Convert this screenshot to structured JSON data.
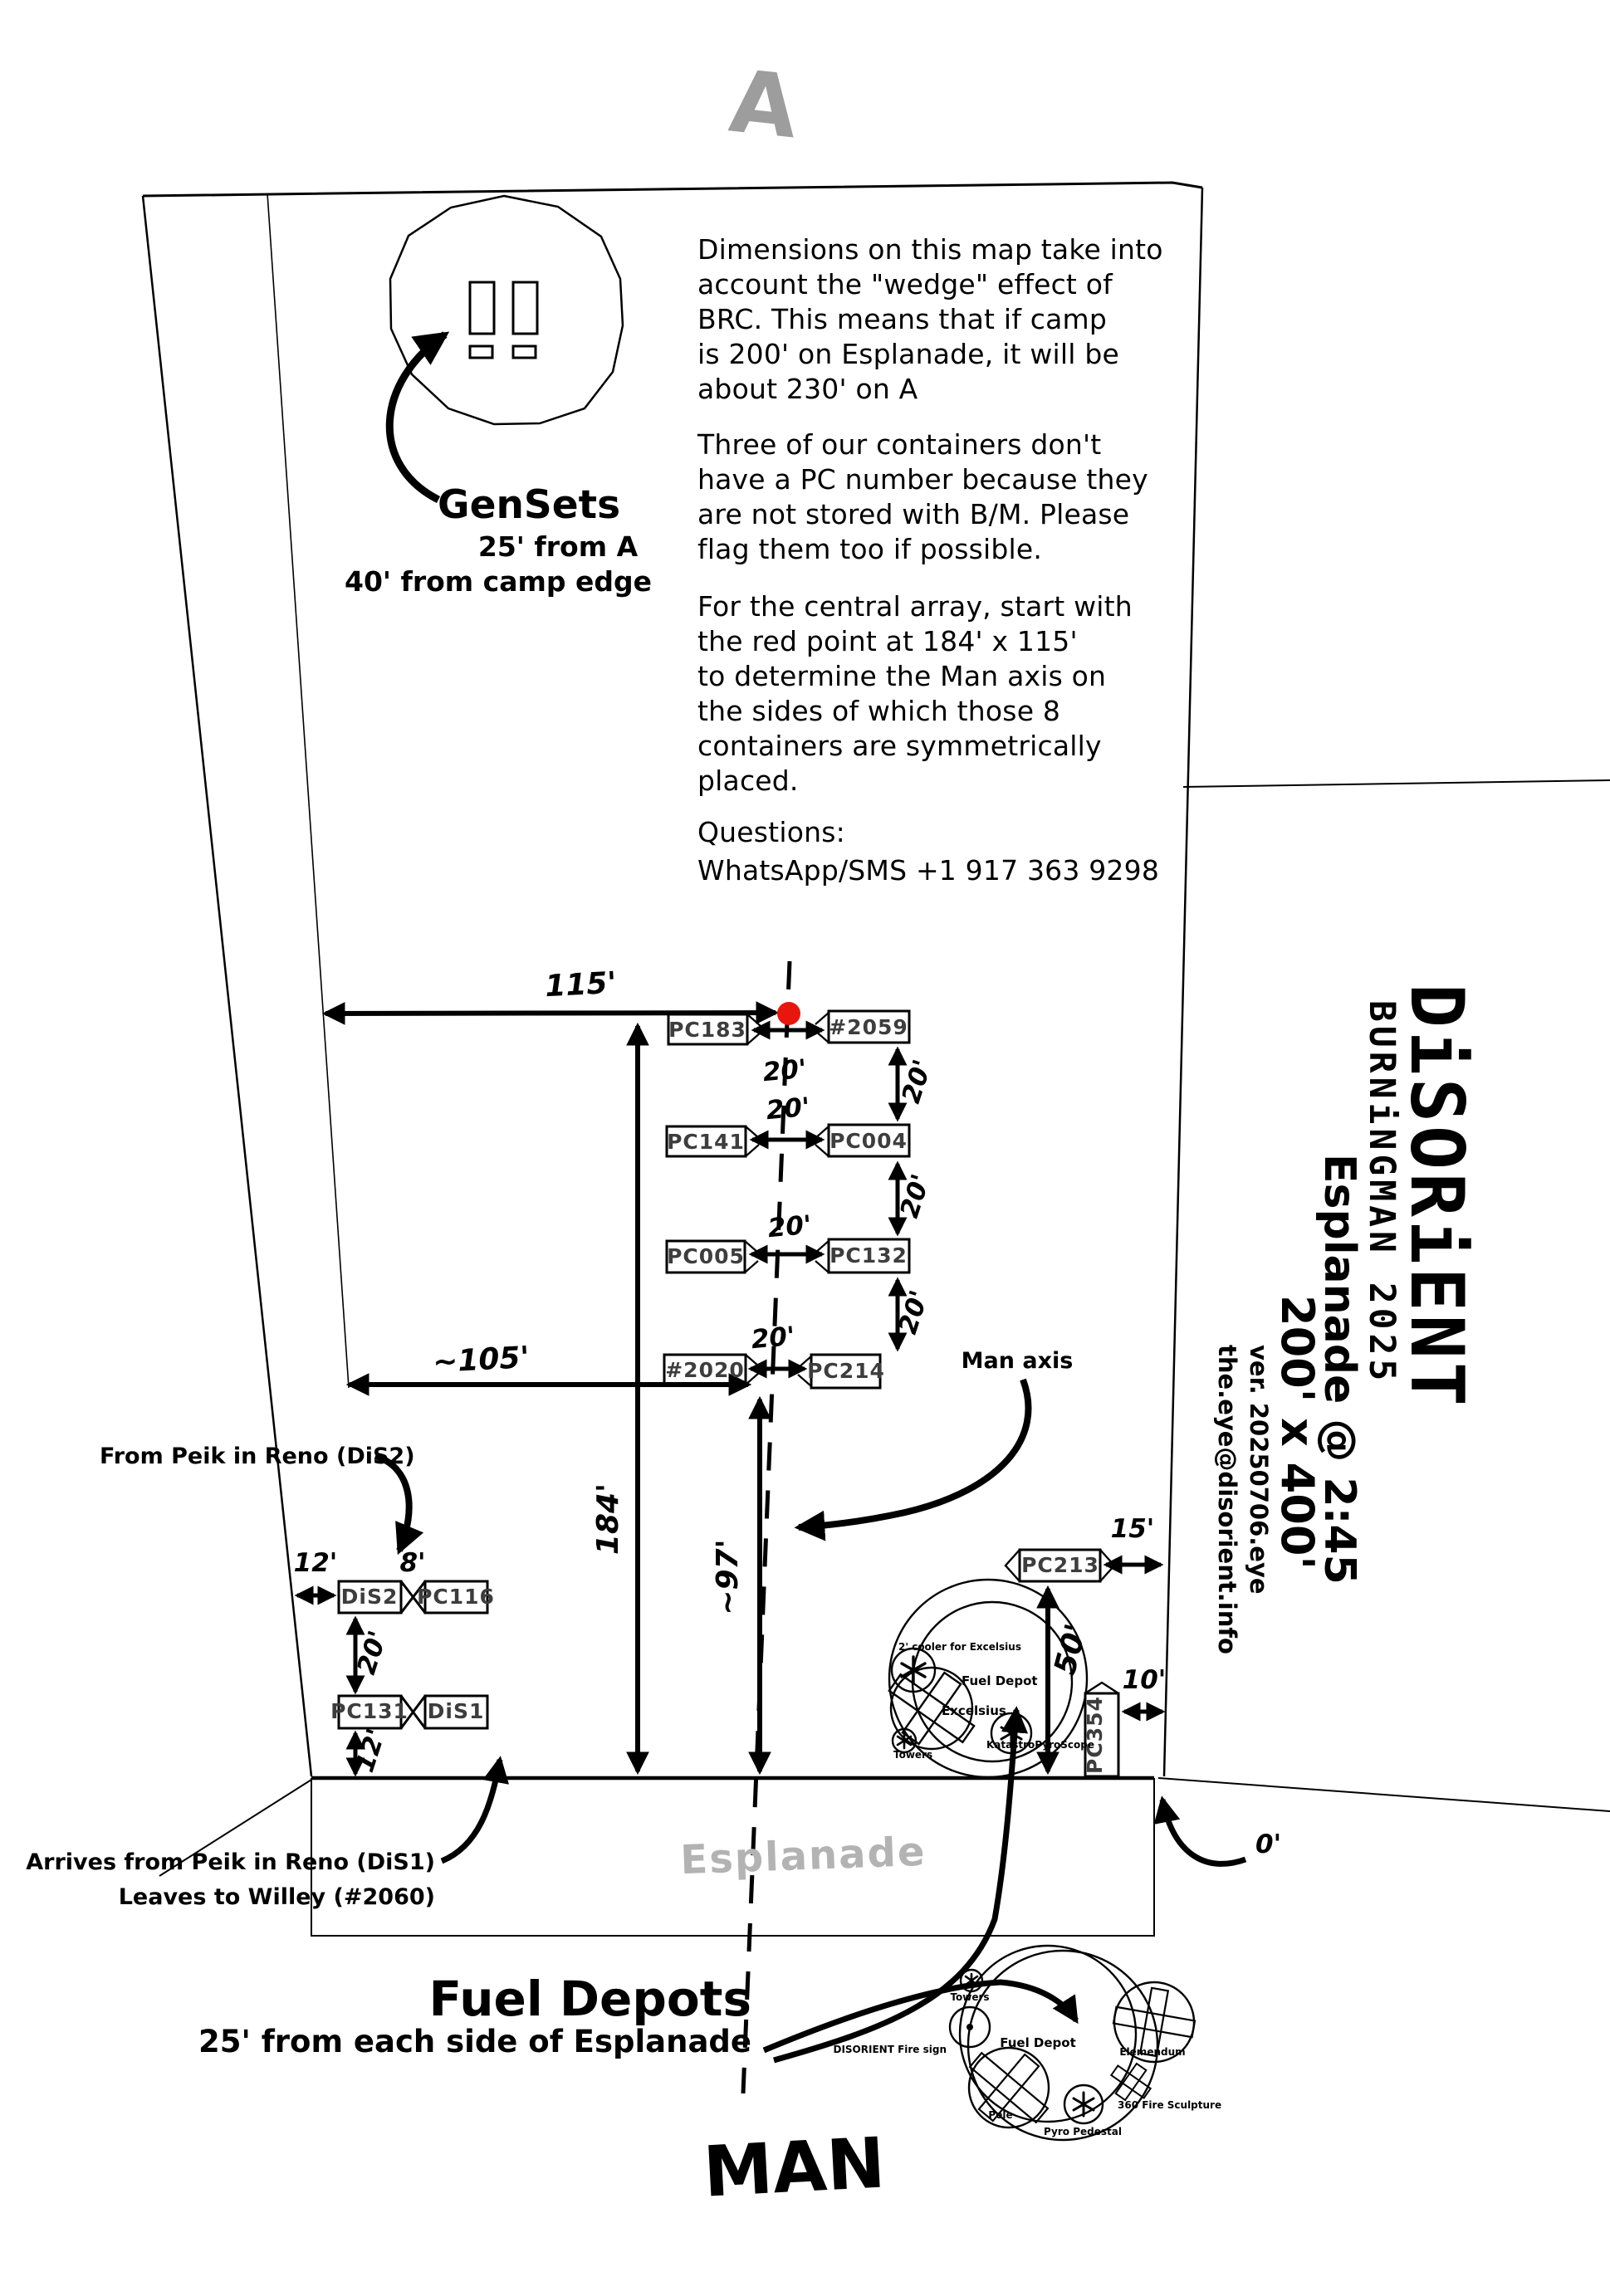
{
  "colors": {
    "red_point": "#e8160c",
    "muted_gray": "#b3b3b3"
  },
  "header": {
    "street_letter": "A"
  },
  "gensets": {
    "title": "GenSets",
    "line1": "25' from A",
    "line2": "40' from camp edge"
  },
  "notes": {
    "para1": [
      "Dimensions on this map take into",
      "account the \"wedge\" effect of",
      "BRC. This means that if camp",
      "is 200' on Esplanade, it will be",
      "about 230' on A"
    ],
    "para2": [
      "Three of our containers don't",
      "have a PC number because they",
      "are not stored with B/M. Please",
      "flag them too if possible."
    ],
    "para3": [
      "For the central array, start with",
      "the red point at 184' x 115'",
      "to determine the Man axis on",
      "the sides of which those 8",
      "containers are symmetrically",
      "placed."
    ],
    "questions": "Questions:",
    "contact": "WhatsApp/SMS +1 917 363 9298"
  },
  "array": {
    "rows": [
      {
        "left": "PC183",
        "right": "#2059"
      },
      {
        "left": "PC141",
        "right": "PC004"
      },
      {
        "left": "PC005",
        "right": "PC132"
      },
      {
        "left": "#2020",
        "right": "PC214"
      }
    ],
    "h_gap_labels": [
      "20'",
      "20'",
      "20'",
      "20'"
    ],
    "v_gap_labels": [
      "20'",
      "20'",
      "20'"
    ]
  },
  "dims": {
    "d115": "115'",
    "d105": "~105'",
    "d184": "184'",
    "d97": "~97'",
    "d15": "15'",
    "d50": "50'",
    "d10": "10'",
    "d0": "0'",
    "d12": "12'",
    "d8": "8'",
    "d20": "20'",
    "d12b": "12'"
  },
  "west": {
    "dis2": "DiS2",
    "pc116": "PC116",
    "pc131": "PC131",
    "dis1": "DiS1",
    "from_note": "From Peik in Reno (DiS2)",
    "arrive_note": "Arrives from Peik in Reno (DiS1)",
    "leave_note": "Leaves to Willey (#2060)"
  },
  "axis": {
    "label": "Man axis",
    "man": "MAN"
  },
  "esplanade": {
    "label": "Esplanade"
  },
  "fuel": {
    "title": "Fuel Depots",
    "note": "25' from each side of Esplanade"
  },
  "east": {
    "pc213": "PC213",
    "pc354": "PC354"
  },
  "upper_depot": {
    "cooler": "2' cooler for Excelsius",
    "fuel": "Fuel Depot",
    "excelsius": "Excelsius",
    "towers": "Towers",
    "kata": "KatastroPyroScope"
  },
  "lower_depot": {
    "fuel": "Fuel Depot",
    "towers": "Towers",
    "sign": "DISORIENT Fire sign",
    "pele": "Pele",
    "pyro": "Pyro Pedestal",
    "elem": "Elemendum",
    "sculpt": "360 Fire Sculpture"
  },
  "brand": {
    "title": "DiSORiENT",
    "subtitle": "BURNiNGMAN 2025",
    "loc": "Esplanade @ 2:45",
    "size": "200' x 400'",
    "version": "ver. 20250706.eye",
    "email": "the.eye@disorient.info"
  }
}
